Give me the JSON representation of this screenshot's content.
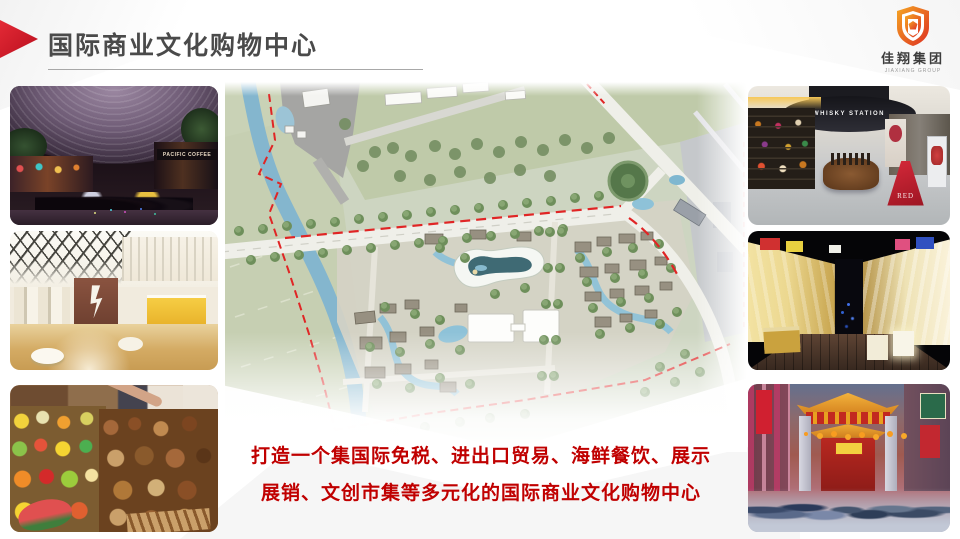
{
  "slide": {
    "title": "国际商业文化购物中心",
    "description_line1": "打造一个集国际免税、进出口贸易、海鲜餐饮、展示",
    "description_line2": "展销、文创市集等多元化的国际商业文化购物中心"
  },
  "logo": {
    "name_cn": "佳翔集团",
    "name_en": "JIAXIANG GROUP"
  },
  "photos": {
    "left": [
      {
        "name": "night-shopping-street",
        "sign": "PACIFIC COFFEE"
      },
      {
        "name": "mall-lobby",
        "sign": ""
      },
      {
        "name": "food-market",
        "sign": ""
      }
    ],
    "right": [
      {
        "name": "duty-free-whisky-shop",
        "sign": "WHISKY STATION",
        "stand_label": "RED"
      },
      {
        "name": "night-market-street",
        "sign": ""
      },
      {
        "name": "temple-gate-street",
        "sign": ""
      }
    ]
  },
  "colors": {
    "accent_red": "#c8102e",
    "title_gray": "#4a4a4a",
    "text_red": "#c00000",
    "logo_orange": "#f5a623",
    "logo_red": "#e0392b",
    "map_boundary_red": "#e02525",
    "map_water_blue": "#84b6ce",
    "map_green": "#cdd5c1"
  }
}
